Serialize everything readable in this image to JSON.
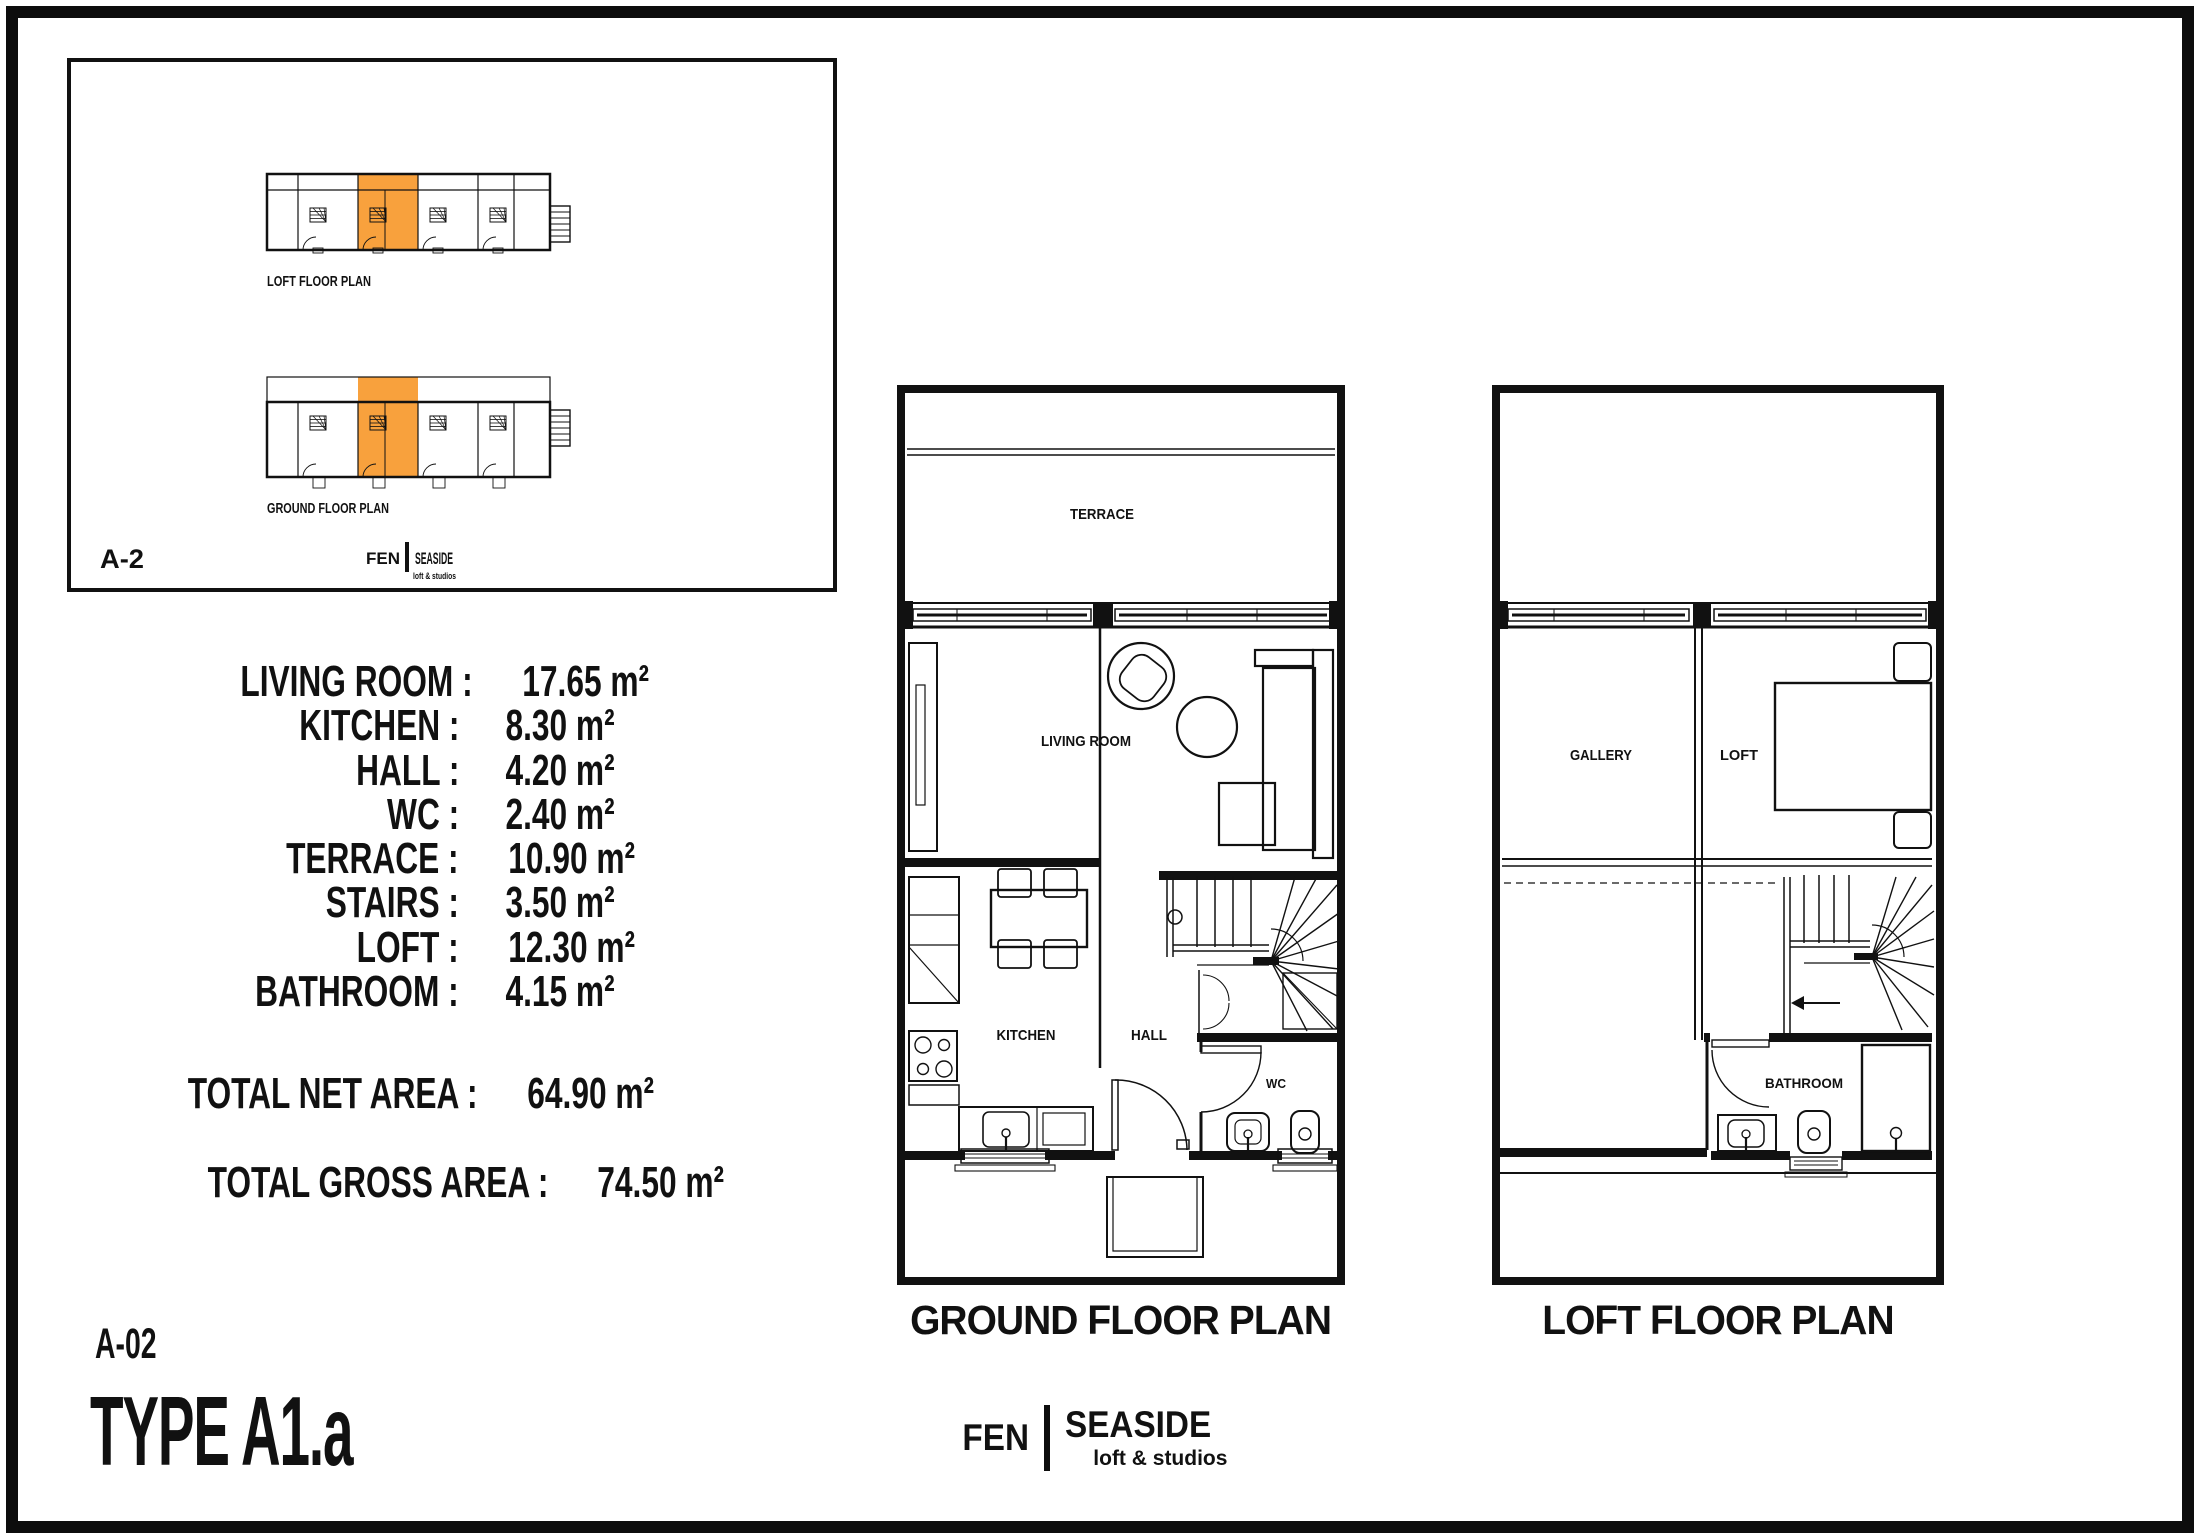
{
  "colors": {
    "highlight": "#F8A13D",
    "line": "#111111",
    "background": "#FFFFFF"
  },
  "inset": {
    "unit_code": "A-2",
    "loft_strip_label": "LOFT FLOOR PLAN",
    "ground_strip_label": "GROUND FLOOR PLAN",
    "logo": {
      "brand_left": "FEN",
      "brand_right": "SEASIDE",
      "tagline": "loft & studios"
    }
  },
  "area_table": {
    "rows": [
      {
        "label": "LIVING ROOM :",
        "value": "17.65 m²"
      },
      {
        "label": "KITCHEN :",
        "value": "8.30 m²"
      },
      {
        "label": "HALL :",
        "value": "4.20 m²"
      },
      {
        "label": "WC :",
        "value": "2.40 m²"
      },
      {
        "label": "TERRACE :",
        "value": "10.90 m²"
      },
      {
        "label": "STAIRS :",
        "value": "3.50 m²"
      },
      {
        "label": "LOFT :",
        "value": "12.30 m²"
      },
      {
        "label": "BATHROOM :",
        "value": "4.15 m²"
      }
    ],
    "totals": [
      {
        "label": "TOTAL NET AREA :",
        "value": "64.90 m²"
      },
      {
        "label": "TOTAL GROSS AREA :",
        "value": "74.50 m²"
      }
    ]
  },
  "sheet": {
    "code": "A-02",
    "type_label": "TYPE A1.a"
  },
  "ground_plan": {
    "title": "GROUND FLOOR PLAN",
    "rooms": {
      "terrace": "TERRACE",
      "living_room": "LIVING ROOM",
      "kitchen": "KITCHEN",
      "hall": "HALL",
      "wc": "WC"
    }
  },
  "loft_plan": {
    "title": "LOFT FLOOR PLAN",
    "rooms": {
      "gallery": "GALLERY",
      "loft": "LOFT",
      "bathroom": "BATHROOM"
    }
  },
  "footer_logo": {
    "brand_left": "FEN",
    "brand_right": "SEASIDE",
    "tagline": "loft & studios"
  }
}
